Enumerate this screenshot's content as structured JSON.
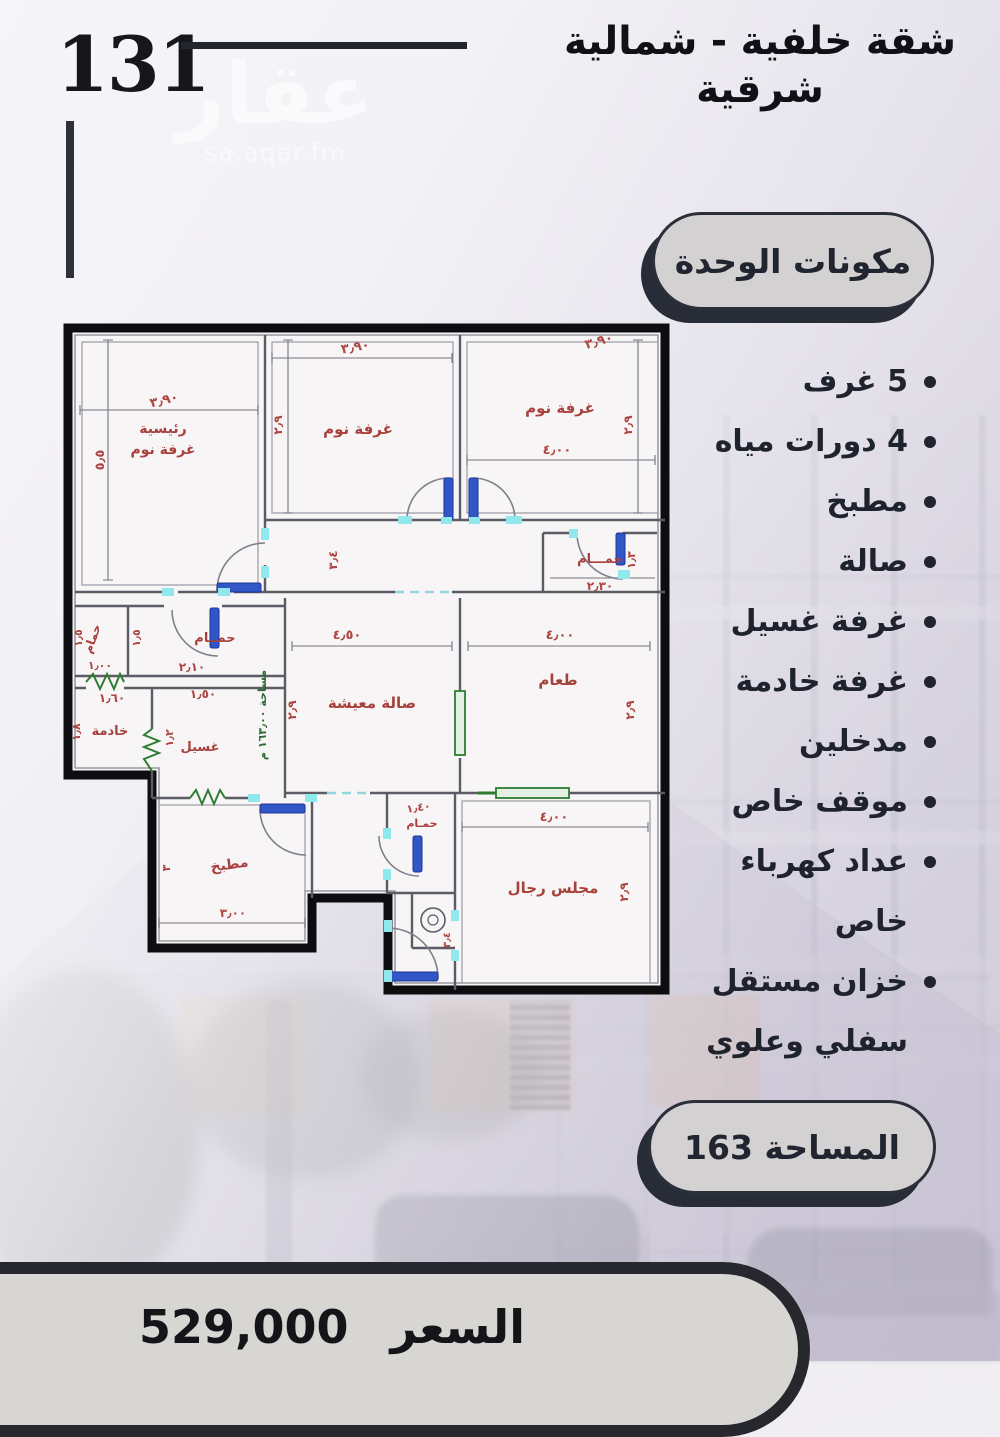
{
  "header": {
    "unit_number": "131",
    "title_line1": "شقة خلفية - شمالية",
    "title_line2": "شرقية",
    "watermark": "عقار",
    "watermark_domain": "sa.aqar.fm"
  },
  "components": {
    "heading": "مكونات الوحدة",
    "items": [
      "5 غرف",
      "4 دورات مياه",
      "مطبخ",
      "صالة",
      "غرفة غسيل",
      "غرفة خادمة",
      "مدخلين",
      "موقف خاص",
      "عداد كهرباء خاص",
      "خزان مستقل سفلي وعلوي"
    ]
  },
  "area_badge": "المساحة 163",
  "price": {
    "label": "السعر",
    "value": "529,000"
  },
  "floor_plan": {
    "area_note": "مساحة ١٦٣٫٠٠ م",
    "rooms": {
      "master_bedroom": {
        "name_line1": "رئيسية",
        "name_line2": "غرفة نوم",
        "width": "٣٫٩٠",
        "height": "٥٫٥"
      },
      "bedroom_2": {
        "name": "غرفة نوم",
        "width": "٣٫٩٠",
        "height": "٢٫٩"
      },
      "bedroom_3": {
        "name": "غرفة نوم",
        "width": "٣٫٩٠",
        "inner_width": "٤٫٠٠",
        "height": "٢٫٩"
      },
      "corridor": {
        "width": "٣٫٤"
      },
      "bathroom_corridor": {
        "name": "حمـــام",
        "width": "٢٫٣٠",
        "height": "١٫٣"
      },
      "bathroom_small": {
        "name": "حمام",
        "width": "١٫٠٠",
        "height": "١٫٥"
      },
      "bathroom_2": {
        "name": "حمــام",
        "width": "٢٫١٠",
        "height": "١٫٥"
      },
      "maid_room": {
        "name": "خادمة",
        "width": "١٫٦٠",
        "height": "١٫٨"
      },
      "laundry": {
        "name": "غسيل",
        "width": "١٫٥٠",
        "height": "١٫٢"
      },
      "living": {
        "name": "صالة معيشة",
        "width": "٤٫٥٠",
        "height": "٢٫٩"
      },
      "dining": {
        "name": "طعام",
        "width": "٤٫٠٠",
        "height": "٢٫٩"
      },
      "kitchen": {
        "name": "مطبخ",
        "width": "٣٫٠٠",
        "height": "٣"
      },
      "bathroom_3": {
        "name": "حمـام",
        "width": "١٫٤٠"
      },
      "majlis": {
        "name": "مجلس رجال",
        "width": "٤٫٠٠",
        "height": "٢٫٩"
      },
      "entry": {
        "width": "٣٫٤"
      }
    }
  },
  "colors": {
    "label_red": "#a8403c",
    "door_blue": "#3056c8",
    "opening_cyan": "#8fe8ec",
    "symbol_green": "#2e7d32",
    "pill_fill": "#d3d1d2",
    "pill_shadow": "#272c37",
    "text_dark": "#1f232e"
  }
}
